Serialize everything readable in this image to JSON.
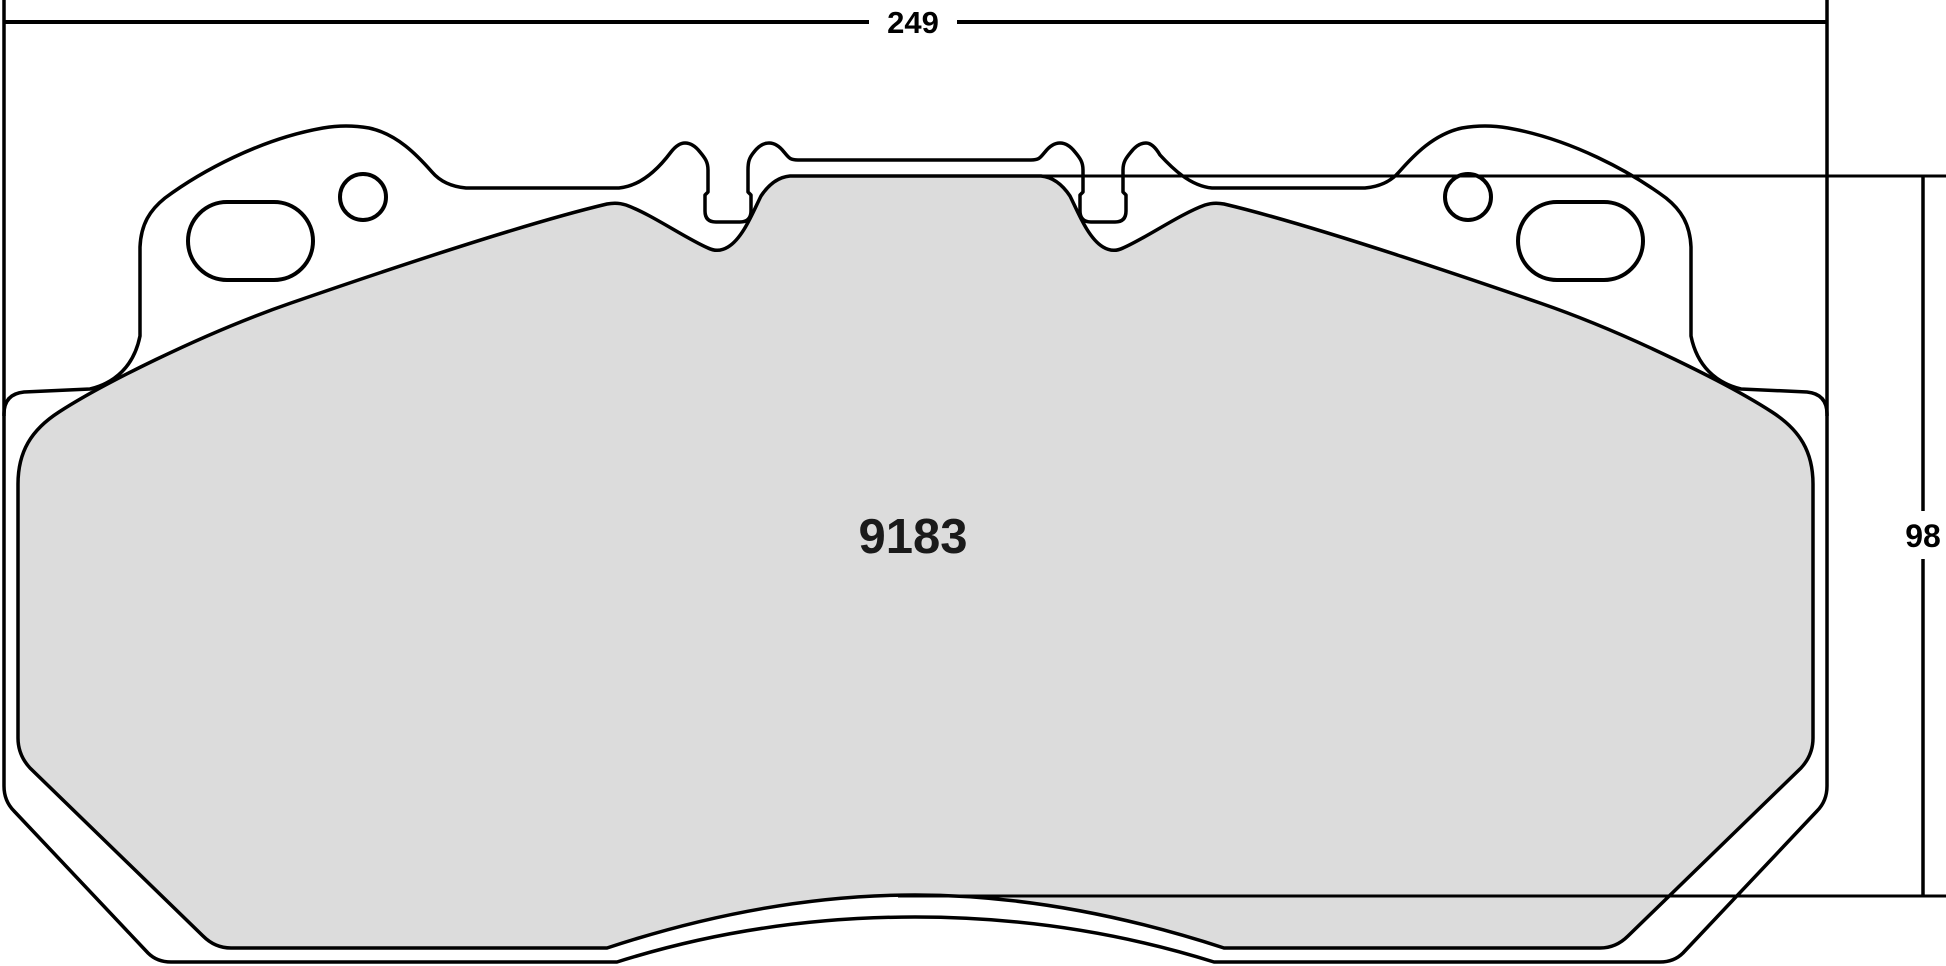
{
  "drawing": {
    "type": "brake-pad-technical-drawing",
    "part_number": "9183",
    "dimensions": {
      "width_label": "249",
      "height_label": "98"
    },
    "colors": {
      "background": "#FFFFFF",
      "outline": "#000000",
      "pad_fill": "#DCDCDC"
    }
  }
}
